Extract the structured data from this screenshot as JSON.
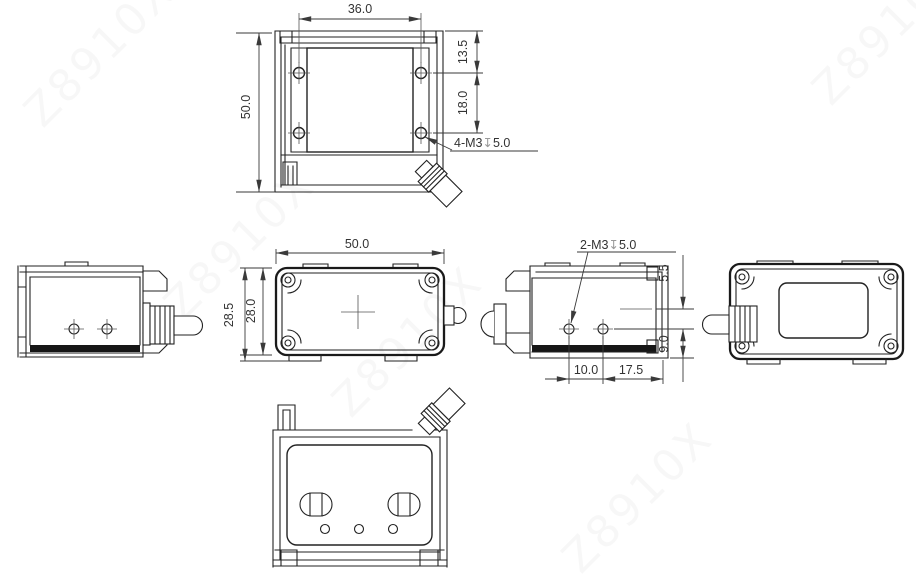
{
  "watermark": {
    "text": "Z8910X"
  },
  "colors": {
    "line": "#222222",
    "dim_text": "#333333",
    "dark_band": "#161616",
    "depth_symbol": "#9a9a9a"
  },
  "views": {
    "top": {
      "dim_hole_span": "36.0",
      "dim_height": "50.0",
      "dim_hole_top_offset": "13.5",
      "dim_hole_pitch": "18.0",
      "thread_note": {
        "count_size": "4-M3",
        "depth_symbol": "↧",
        "depth": "5.0"
      }
    },
    "front": {
      "dim_width": "50.0",
      "dim_height_overall": "28.5",
      "dim_height_body": "28.0"
    },
    "right_side": {
      "thread_note": {
        "count_size": "2-M3",
        "depth_symbol": "↧",
        "depth": "5.0"
      },
      "dim_top_offset": "5.5",
      "dim_hole_to_base": "9.0",
      "dim_hole_offset": "10.0",
      "dim_hole_pitch": "17.5"
    }
  }
}
